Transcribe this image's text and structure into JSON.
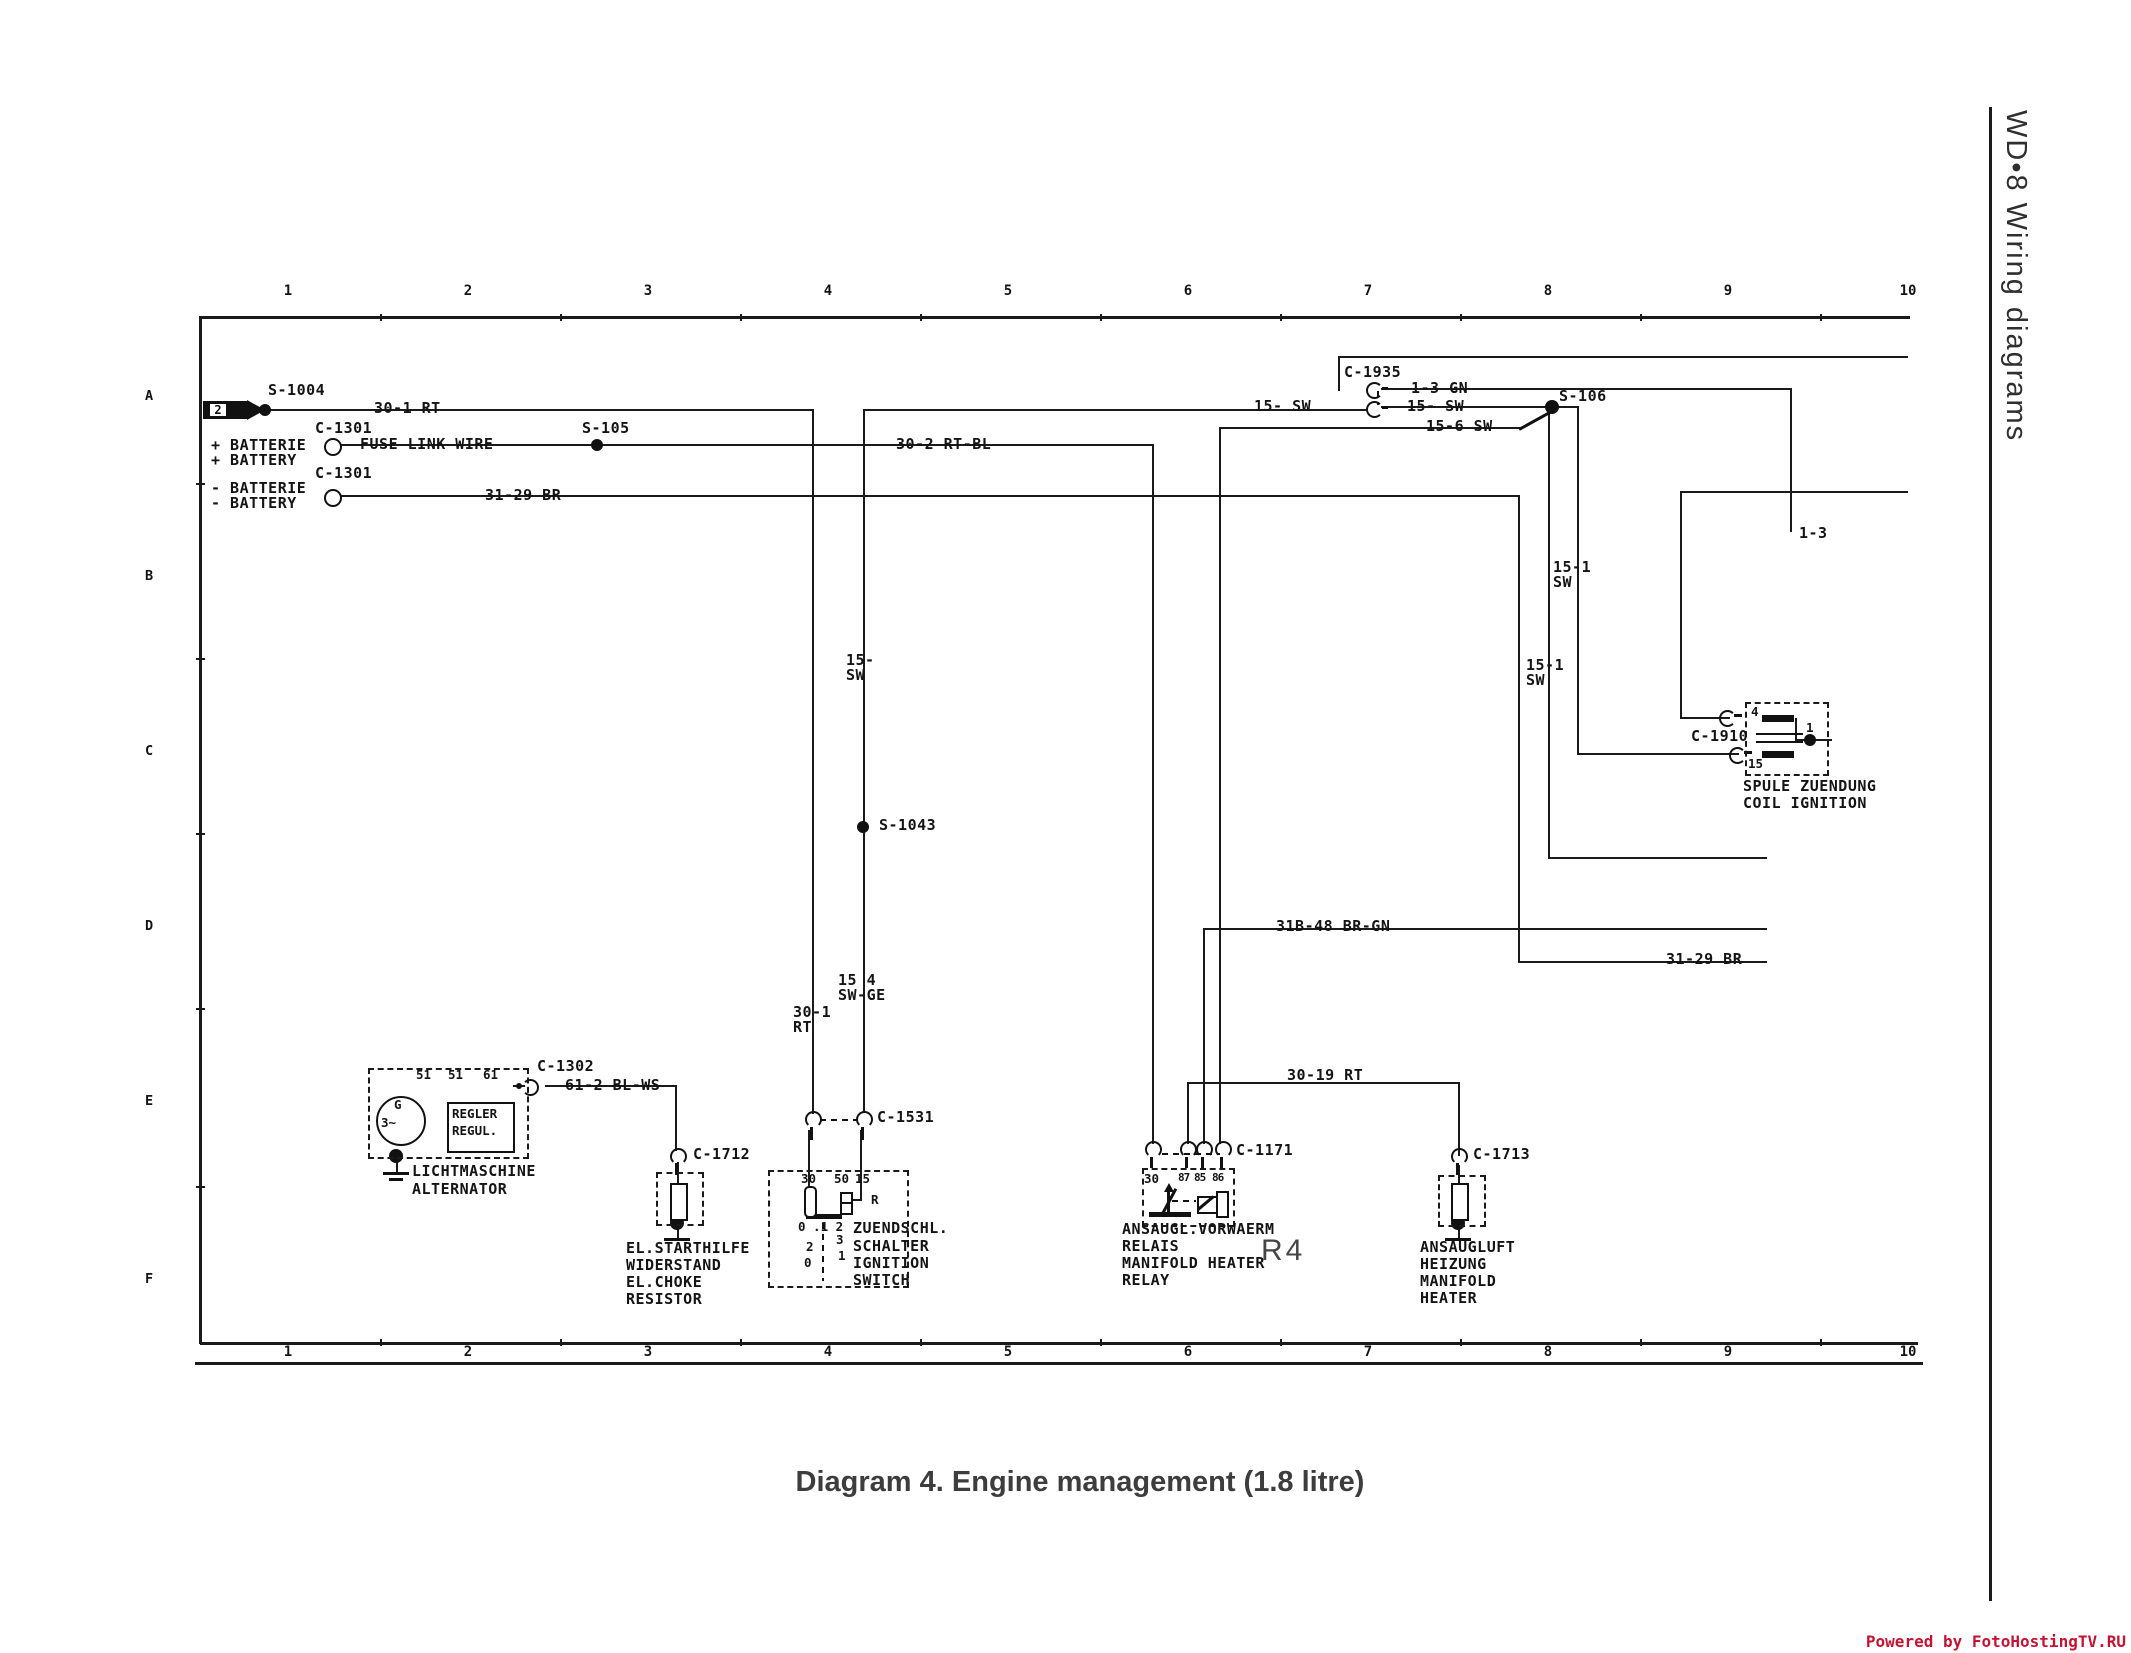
{
  "page": {
    "side_title": "WD•8  Wiring diagrams",
    "caption": "Diagram 4. Engine management (1.8 litre)",
    "watermark": "Powered by FotoHostingTV.RU",
    "watermark_color": "#c41434",
    "ink_color": "#1a1a1a",
    "flag_number": "2"
  },
  "rulers": {
    "numbers": [
      "1",
      "2",
      "3",
      "4",
      "5",
      "6",
      "7",
      "8",
      "9",
      "10"
    ],
    "xs": [
      288,
      468,
      648,
      828,
      1008,
      1188,
      1368,
      1548,
      1728,
      1908
    ],
    "top_number_y": 283,
    "bottom_number_y": 1344
  },
  "row_letters": [
    {
      "t": "A",
      "x": 145,
      "y": 388
    },
    {
      "t": "B",
      "x": 145,
      "y": 568
    },
    {
      "t": "C",
      "x": 145,
      "y": 743
    },
    {
      "t": "D",
      "x": 145,
      "y": 918
    },
    {
      "t": "E",
      "x": 145,
      "y": 1093
    },
    {
      "t": "F",
      "x": 145,
      "y": 1271
    }
  ],
  "labels": [
    {
      "t": "S-1004",
      "x": 268,
      "y": 383
    },
    {
      "t": "30-1 RT",
      "x": 374,
      "y": 401
    },
    {
      "t": "C-1301",
      "x": 315,
      "y": 421
    },
    {
      "t": "+ BATTERIE",
      "x": 211,
      "y": 438
    },
    {
      "t": "+ BATTERY",
      "x": 211,
      "y": 453
    },
    {
      "t": "FUSE LINK WIRE",
      "x": 360,
      "y": 437
    },
    {
      "t": "S-105",
      "x": 582,
      "y": 421
    },
    {
      "t": "30-2 RT-BL",
      "x": 896,
      "y": 437
    },
    {
      "t": "C-1301",
      "x": 315,
      "y": 466
    },
    {
      "t": "- BATTERIE",
      "x": 211,
      "y": 481
    },
    {
      "t": "- BATTERY",
      "x": 211,
      "y": 496
    },
    {
      "t": "31-29 BR",
      "x": 485,
      "y": 488
    },
    {
      "t": "C-1935",
      "x": 1344,
      "y": 365
    },
    {
      "t": "1-3 GN",
      "x": 1411,
      "y": 381
    },
    {
      "t": "15- SW",
      "x": 1254,
      "y": 399
    },
    {
      "t": "15- SW",
      "x": 1407,
      "y": 399
    },
    {
      "t": "15-6 SW",
      "x": 1426,
      "y": 419
    },
    {
      "t": "S-106",
      "x": 1559,
      "y": 389
    },
    {
      "t": "1-3",
      "x": 1799,
      "y": 526
    },
    {
      "t": "15-1\nSW",
      "x": 1553,
      "y": 560
    },
    {
      "t": "15-1\nSW",
      "x": 1526,
      "y": 658
    },
    {
      "t": "15-\nSW",
      "x": 846,
      "y": 653
    },
    {
      "t": "S-1043",
      "x": 879,
      "y": 818
    },
    {
      "t": "15 4\nSW-GE",
      "x": 838,
      "y": 973
    },
    {
      "t": "30-1\nRT",
      "x": 793,
      "y": 1005
    },
    {
      "t": "31B-48 BR-GN",
      "x": 1276,
      "y": 919
    },
    {
      "t": "31-29 BR",
      "x": 1666,
      "y": 952
    },
    {
      "t": "30-19 RT",
      "x": 1287,
      "y": 1068
    },
    {
      "t": "C-1910",
      "x": 1691,
      "y": 729
    },
    {
      "t": "SPULE ZUENDUNG",
      "x": 1743,
      "y": 779
    },
    {
      "t": "COIL IGNITION",
      "x": 1743,
      "y": 796
    },
    {
      "t": "4",
      "x": 1751,
      "y": 705,
      "cls": "sm"
    },
    {
      "t": "15",
      "x": 1748,
      "y": 757,
      "cls": "sm"
    },
    {
      "t": "1",
      "x": 1806,
      "y": 721,
      "cls": "sm"
    },
    {
      "t": "C-1302",
      "x": 537,
      "y": 1059
    },
    {
      "t": "61-2 BL-WS",
      "x": 565,
      "y": 1078
    },
    {
      "t": "51",
      "x": 416,
      "y": 1068,
      "cls": "sm"
    },
    {
      "t": "51",
      "x": 448,
      "y": 1068,
      "cls": "sm"
    },
    {
      "t": "61",
      "x": 483,
      "y": 1068,
      "cls": "sm"
    },
    {
      "t": "G",
      "x": 394,
      "y": 1098,
      "cls": "sm"
    },
    {
      "t": "3~",
      "x": 381,
      "y": 1116,
      "cls": "sm"
    },
    {
      "t": "REGLER",
      "x": 452,
      "y": 1107,
      "cls": "sm"
    },
    {
      "t": "REGUL.",
      "x": 452,
      "y": 1124,
      "cls": "sm"
    },
    {
      "t": "LICHTMASCHINE",
      "x": 412,
      "y": 1164
    },
    {
      "t": "ALTERNATOR",
      "x": 412,
      "y": 1182
    },
    {
      "t": "C-1712",
      "x": 693,
      "y": 1147
    },
    {
      "t": "EL.STARTHILFE",
      "x": 626,
      "y": 1241
    },
    {
      "t": "WIDERSTAND",
      "x": 626,
      "y": 1258
    },
    {
      "t": "EL.CHOKE",
      "x": 626,
      "y": 1275
    },
    {
      "t": "RESISTOR",
      "x": 626,
      "y": 1292
    },
    {
      "t": "C-1531",
      "x": 877,
      "y": 1110
    },
    {
      "t": "30",
      "x": 801,
      "y": 1172,
      "cls": "sm"
    },
    {
      "t": "50",
      "x": 834,
      "y": 1172,
      "cls": "sm"
    },
    {
      "t": "15",
      "x": 855,
      "y": 1172,
      "cls": "sm"
    },
    {
      "t": "R",
      "x": 871,
      "y": 1193,
      "cls": "sm"
    },
    {
      "t": "0 .1 2",
      "x": 798,
      "y": 1220,
      "cls": "sm"
    },
    {
      "t": "2",
      "x": 806,
      "y": 1240,
      "cls": "sm"
    },
    {
      "t": "3",
      "x": 836,
      "y": 1233,
      "cls": "sm"
    },
    {
      "t": "1",
      "x": 838,
      "y": 1249,
      "cls": "sm"
    },
    {
      "t": "0",
      "x": 804,
      "y": 1256,
      "cls": "sm"
    },
    {
      "t": "ZUENDSCHL.",
      "x": 853,
      "y": 1221
    },
    {
      "t": "SCHALTER",
      "x": 853,
      "y": 1239
    },
    {
      "t": "IGNITION",
      "x": 853,
      "y": 1256
    },
    {
      "t": "SWITCH",
      "x": 853,
      "y": 1273
    },
    {
      "t": "C-1171",
      "x": 1236,
      "y": 1143
    },
    {
      "t": "30",
      "x": 1144,
      "y": 1172,
      "cls": "sm"
    },
    {
      "t": "87",
      "x": 1178,
      "y": 1172,
      "cls": "xs"
    },
    {
      "t": "85",
      "x": 1194,
      "y": 1172,
      "cls": "xs"
    },
    {
      "t": "86",
      "x": 1212,
      "y": 1172,
      "cls": "xs"
    },
    {
      "t": "ANSAUGL.VORWAERM",
      "x": 1122,
      "y": 1222
    },
    {
      "t": "RELAIS",
      "x": 1122,
      "y": 1239
    },
    {
      "t": "MANIFOLD HEATER",
      "x": 1122,
      "y": 1256
    },
    {
      "t": "RELAY",
      "x": 1122,
      "y": 1273
    },
    {
      "t": "R4",
      "x": 1261,
      "y": 1236,
      "cls": "big"
    },
    {
      "t": "C-1713",
      "x": 1473,
      "y": 1147
    },
    {
      "t": "ANSAUGLUFT",
      "x": 1420,
      "y": 1240
    },
    {
      "t": "HEIZUNG",
      "x": 1420,
      "y": 1257
    },
    {
      "t": "MANIFOLD",
      "x": 1420,
      "y": 1274
    },
    {
      "t": "HEATER",
      "x": 1420,
      "y": 1291
    }
  ],
  "geometry": {
    "frame": [
      [
        200,
        316,
        1710,
        2.5
      ],
      [
        199,
        316,
        2.5,
        1028
      ],
      [
        200,
        1342,
        1718,
        2.5
      ],
      [
        195,
        1362,
        1728,
        2.5
      ],
      [
        1989,
        107,
        2.5,
        1494
      ]
    ],
    "ticks": [
      [
        380,
        314,
        2,
        7
      ],
      [
        560,
        314,
        2,
        7
      ],
      [
        740,
        314,
        2,
        7
      ],
      [
        920,
        314,
        2,
        7
      ],
      [
        1100,
        314,
        2,
        7
      ],
      [
        1280,
        314,
        2,
        7
      ],
      [
        1460,
        314,
        2,
        7
      ],
      [
        1640,
        314,
        2,
        7
      ],
      [
        1820,
        314,
        2,
        7
      ],
      [
        380,
        1339,
        2,
        7
      ],
      [
        560,
        1339,
        2,
        7
      ],
      [
        740,
        1339,
        2,
        7
      ],
      [
        920,
        1339,
        2,
        7
      ],
      [
        1100,
        1339,
        2,
        7
      ],
      [
        1280,
        1339,
        2,
        7
      ],
      [
        1460,
        1339,
        2,
        7
      ],
      [
        1640,
        1339,
        2,
        7
      ],
      [
        1820,
        1339,
        2,
        7
      ],
      [
        196,
        483,
        9,
        2
      ],
      [
        196,
        658,
        9,
        2
      ],
      [
        196,
        833,
        9,
        2
      ],
      [
        196,
        1008,
        9,
        2
      ],
      [
        196,
        1186,
        9,
        2
      ]
    ],
    "wires": [
      [
        265,
        409,
        547,
        2
      ],
      [
        338,
        444,
        814,
        2
      ],
      [
        338,
        495,
        1182,
        2
      ],
      [
        863,
        409,
        503,
        2
      ],
      [
        1381,
        406,
        197,
        2
      ],
      [
        1381,
        388,
        411,
        2
      ],
      [
        1338,
        356,
        570,
        2
      ],
      [
        1219,
        427,
        301,
        2
      ],
      [
        1680,
        491,
        228,
        2
      ],
      [
        1680,
        717,
        50,
        2
      ],
      [
        1577,
        753,
        162,
        2
      ],
      [
        1548,
        857,
        219,
        2
      ],
      [
        1203,
        928,
        564,
        2
      ],
      [
        1518,
        961,
        249,
        2
      ],
      [
        1187,
        1082,
        273,
        2
      ],
      [
        545,
        1085,
        132,
        2
      ],
      [
        513,
        1085,
        12,
        2
      ],
      [
        1813,
        739,
        19,
        2
      ],
      [
        846,
        1199,
        16,
        2
      ],
      [
        812,
        409,
        2,
        705
      ],
      [
        863,
        409,
        2,
        704
      ],
      [
        1152,
        444,
        2,
        700
      ],
      [
        1219,
        427,
        2,
        717
      ],
      [
        1518,
        495,
        2,
        468
      ],
      [
        1548,
        406,
        2,
        453
      ],
      [
        1577,
        406,
        2,
        349
      ],
      [
        1680,
        491,
        2,
        228
      ],
      [
        1790,
        388,
        2,
        144
      ],
      [
        1338,
        356,
        2,
        35
      ],
      [
        1187,
        1082,
        2,
        62
      ],
      [
        1203,
        928,
        2,
        216
      ],
      [
        1458,
        1082,
        2,
        74
      ],
      [
        675,
        1085,
        2,
        66
      ],
      [
        396,
        1155,
        2,
        19
      ],
      [
        677,
        1162,
        2,
        23
      ],
      [
        1458,
        1165,
        2,
        20
      ],
      [
        677,
        1222,
        2,
        17
      ],
      [
        1458,
        1222,
        2,
        17
      ],
      [
        808,
        1130,
        2,
        58
      ],
      [
        860,
        1130,
        2,
        71
      ],
      [
        1795,
        718,
        2,
        23
      ],
      [
        1797,
        739,
        13,
        2
      ]
    ],
    "bars": [
      [
        1382,
        387,
        6,
        3
      ],
      [
        1382,
        406,
        6,
        3
      ],
      [
        810,
        1127,
        3,
        13
      ],
      [
        861,
        1127,
        3,
        13
      ],
      [
        1150,
        1157,
        3,
        11
      ],
      [
        1185,
        1157,
        3,
        11
      ],
      [
        1201,
        1157,
        3,
        11
      ],
      [
        1220,
        1157,
        3,
        11
      ],
      [
        675,
        1163,
        3,
        12
      ],
      [
        1456,
        1163,
        3,
        12
      ],
      [
        383,
        1172,
        26,
        3
      ],
      [
        389,
        1178,
        14,
        3
      ],
      [
        664,
        1238,
        26,
        3
      ],
      [
        1445,
        1238,
        26,
        3
      ],
      [
        806,
        1214,
        36,
        5
      ],
      [
        1149,
        1212,
        42,
        5
      ],
      [
        1762,
        715,
        32,
        7
      ],
      [
        1762,
        751,
        32,
        7
      ],
      [
        1756,
        733,
        47,
        2
      ],
      [
        1756,
        741,
        47,
        2
      ],
      [
        1167,
        1192,
        3,
        22
      ],
      [
        1734,
        714,
        8,
        3
      ],
      [
        1744,
        751,
        8,
        3
      ]
    ],
    "dots": [
      [
        265,
        410,
        6
      ],
      [
        597,
        445,
        6
      ],
      [
        1552,
        407,
        7
      ],
      [
        863,
        827,
        6
      ],
      [
        1810,
        740,
        6
      ],
      [
        396,
        1156,
        7
      ],
      [
        677,
        1223,
        7
      ],
      [
        1458,
        1223,
        7
      ],
      [
        519,
        1086,
        3
      ]
    ],
    "open_circles": [
      [
        331,
        445,
        7
      ],
      [
        331,
        496,
        7
      ]
    ],
    "pins_ob": [
      [
        805,
        1111
      ],
      [
        856,
        1111
      ],
      [
        1145,
        1141
      ],
      [
        1180,
        1141
      ],
      [
        1196,
        1141
      ],
      [
        1215,
        1141
      ],
      [
        670,
        1148
      ],
      [
        1451,
        1148
      ]
    ],
    "pins_or": [
      [
        1366,
        382
      ],
      [
        1366,
        401
      ],
      [
        1719,
        710
      ],
      [
        1729,
        747
      ]
    ],
    "pins_ol": [
      [
        522,
        1079
      ]
    ],
    "dash_h": [
      [
        820,
        1119,
        38
      ],
      [
        1162,
        1153,
        58
      ],
      [
        1172,
        1200,
        24
      ]
    ],
    "dash_v": [
      [
        1377,
        391,
        14
      ],
      [
        822,
        1223,
        58
      ]
    ],
    "dboxes": [
      [
        368,
        1068,
        157,
        87
      ],
      [
        656,
        1172,
        44,
        50
      ],
      [
        768,
        1170,
        137,
        114
      ],
      [
        1142,
        1168,
        89,
        55
      ],
      [
        1438,
        1175,
        44,
        48
      ],
      [
        1745,
        702,
        80,
        70
      ]
    ],
    "rects": [
      [
        447,
        1102,
        64,
        47
      ],
      [
        670,
        1183,
        14,
        34
      ],
      [
        1451,
        1183,
        14,
        34
      ],
      [
        1216,
        1191,
        9,
        23
      ],
      [
        1197,
        1196,
        17,
        14
      ],
      [
        840,
        1192,
        9,
        9
      ],
      [
        840,
        1202,
        9,
        9
      ]
    ],
    "ovals": [
      [
        804,
        1186,
        9,
        28
      ]
    ],
    "diagonals": [
      [
        1519,
        428,
        38,
        -29
      ],
      [
        1162,
        1213,
        29,
        -62
      ],
      [
        1198,
        1208,
        20,
        -40
      ]
    ],
    "tri_up": [
      [
        1164,
        1183
      ]
    ],
    "tri_right": [
      [
        404,
        1113
      ]
    ],
    "gcircle": [
      376,
      1096,
      46
    ]
  }
}
